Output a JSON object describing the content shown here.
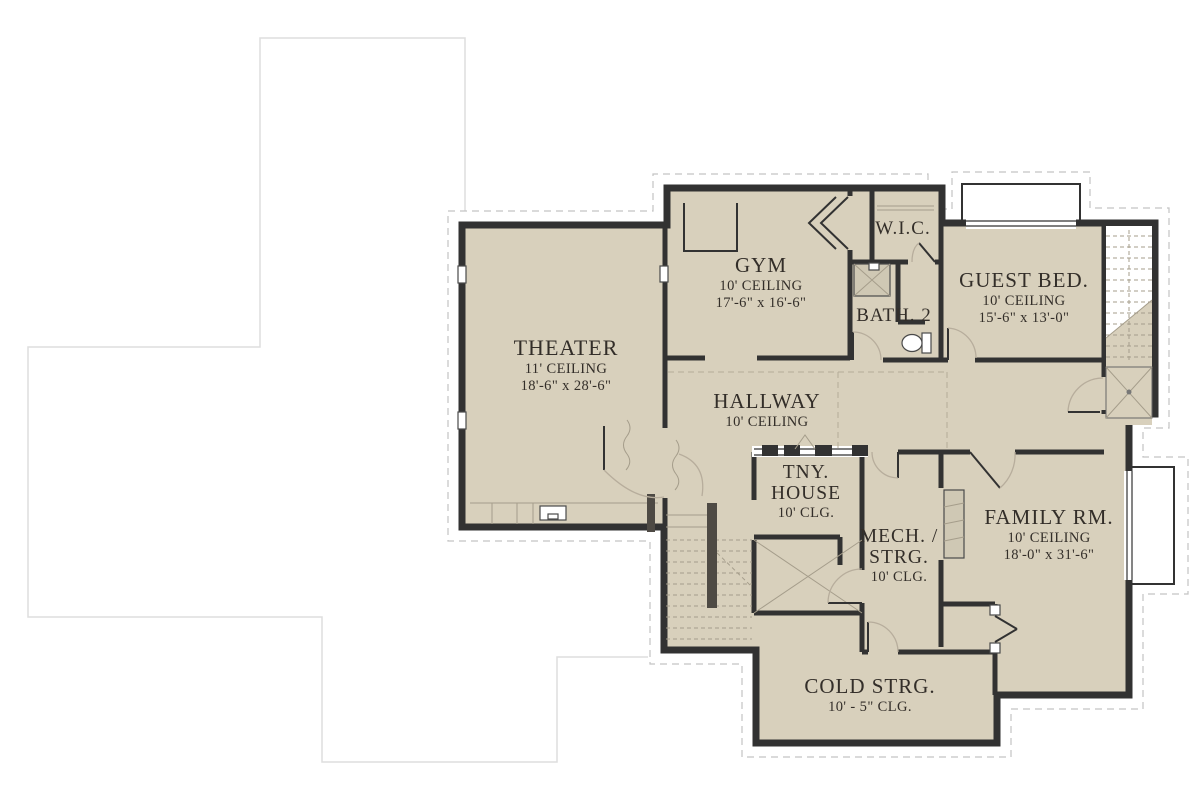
{
  "plan": {
    "type": "architectural-floor-plan",
    "rooms": [
      {
        "id": "theater",
        "name": "THEATER",
        "ceiling": "11' CEILING",
        "dims": "18'-6\" x 28'-6\""
      },
      {
        "id": "gym",
        "name": "GYM",
        "ceiling": "10' CEILING",
        "dims": "17'-6\" x 16'-6\""
      },
      {
        "id": "wic",
        "name": "W.I.C."
      },
      {
        "id": "bath2",
        "name": "BATH. 2"
      },
      {
        "id": "guest_bed",
        "name": "GUEST BED.",
        "ceiling": "10' CEILING",
        "dims": "15'-6\" x 13'-0\""
      },
      {
        "id": "hallway",
        "name": "HALLWAY",
        "ceiling": "10' CEILING"
      },
      {
        "id": "tiny_house",
        "line1": "TNY.",
        "line2": "HOUSE",
        "ceiling": "10' CLG."
      },
      {
        "id": "mech_storage",
        "line1": "MECH. /",
        "line2": "STRG.",
        "ceiling": "10' CLG."
      },
      {
        "id": "family_room",
        "name": "FAMILY RM.",
        "ceiling": "10' CEILING",
        "dims": "18'-0\" x 31'-6\""
      },
      {
        "id": "cold_storage",
        "name": "COLD STRG.",
        "ceiling": "10' - 5\" CLG."
      }
    ],
    "colors": {
      "floor": "#d8d0bc",
      "wall": "#323232",
      "dashed_outline": "#c3c3c3",
      "faint_outline": "#dedede",
      "stair_line": "#a59d8b",
      "door_arc": "#b7ad9c",
      "text": "#332e29",
      "fixture_fill": "#cfc8b4"
    }
  }
}
